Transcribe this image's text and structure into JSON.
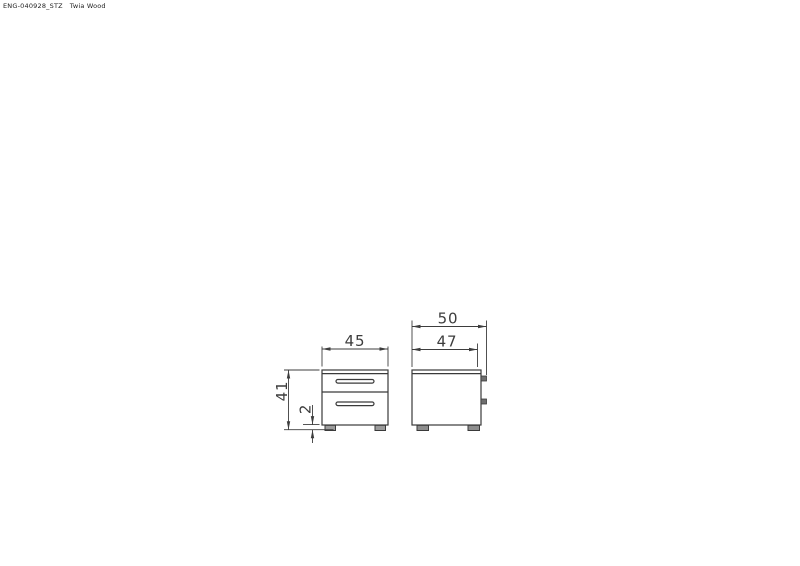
{
  "title_block": {
    "doc_code": "ENG-040928_STZ",
    "product_name": "Twia Wood"
  },
  "drawing": {
    "subject": "two-drawer-bedside-cabinet",
    "dimensions": {
      "front_width": "45",
      "front_height": "41",
      "foot_height": "2",
      "side_overall_depth": "50",
      "side_body_depth": "47"
    },
    "colors": {
      "line": "#3a3a3a",
      "foot_fill": "#9c9c9c",
      "handle_tab_fill": "#6e6e6e"
    }
  }
}
